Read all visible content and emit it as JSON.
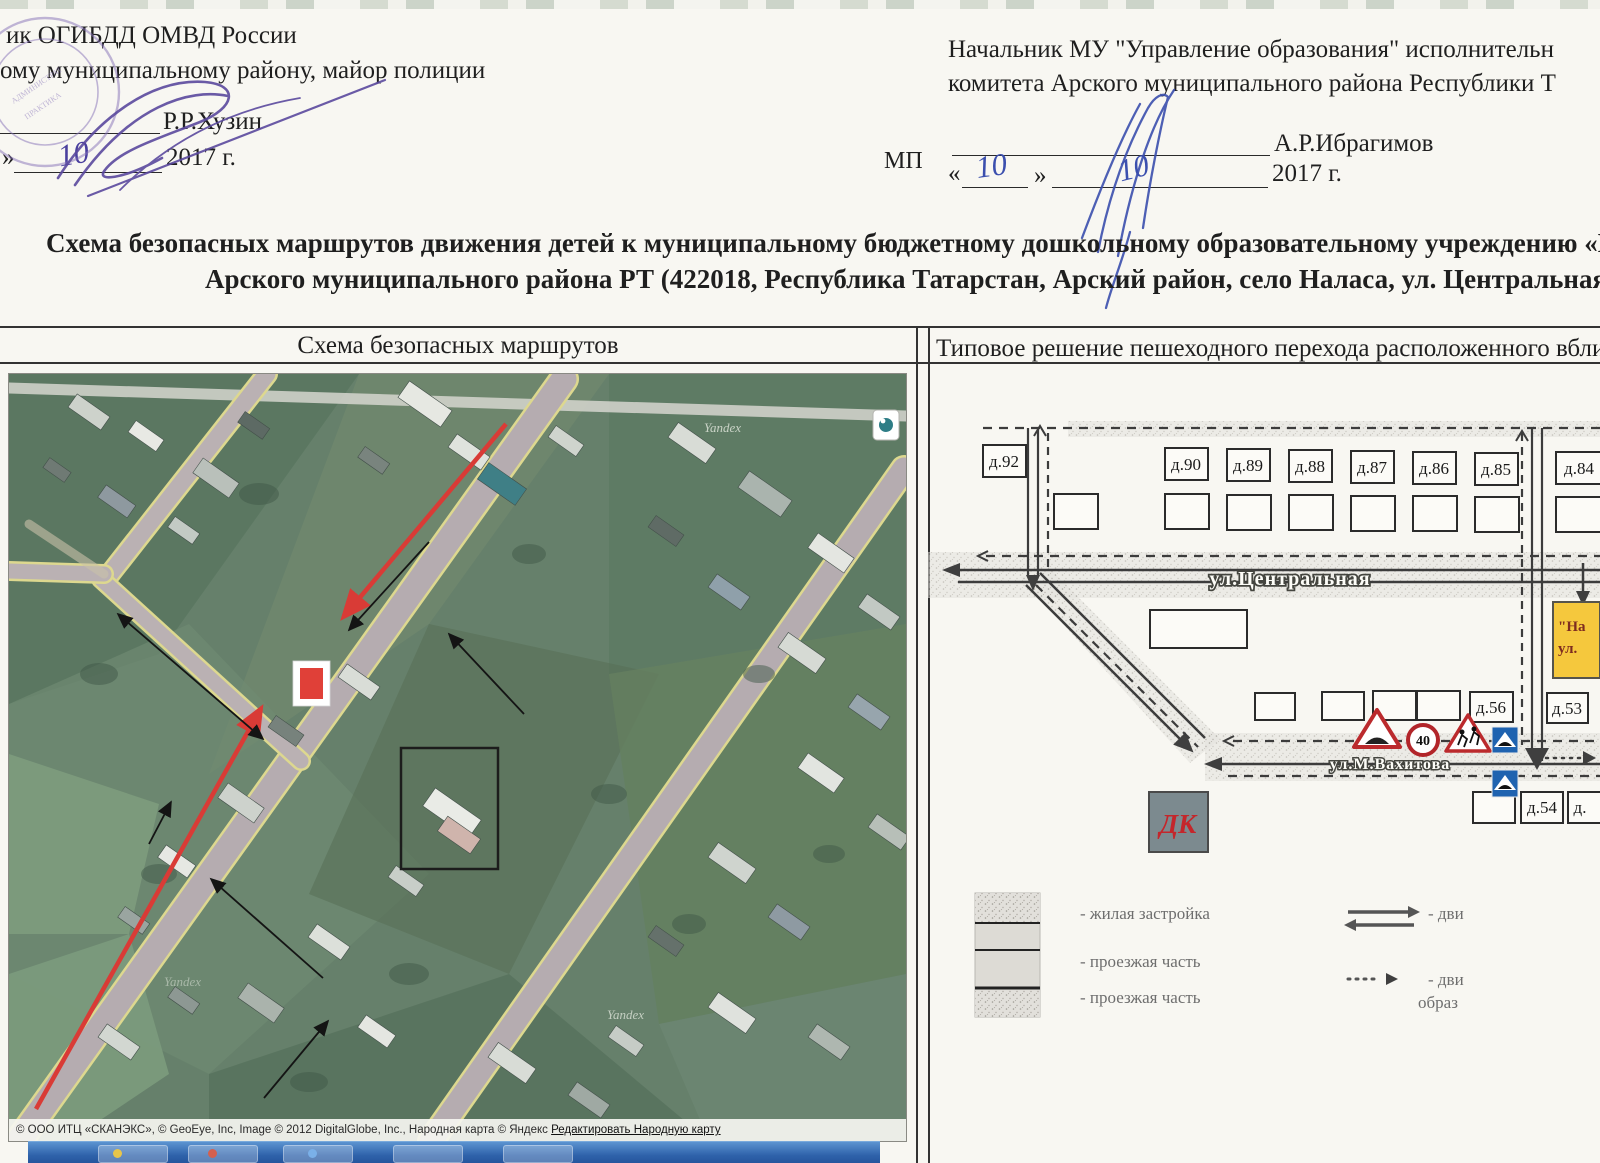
{
  "approvals": {
    "left": {
      "line1": "ик ОГИБДД ОМВД России",
      "line2": "ому муниципальному району, майор полиции",
      "name": "Р.Р.Хузин",
      "quote_close": "»",
      "date_day": "10",
      "year": "2017 г."
    },
    "mp": "МП",
    "right": {
      "line1": "Начальник МУ \"Управление образования\" исполнительн",
      "line2": "комитета Арского муниципального района Республики Т",
      "name": "А.Р.Ибрагимов",
      "quote_open": "«",
      "quote_close": "»",
      "date_day": "10",
      "date_month": "10",
      "year": "2017 г."
    }
  },
  "title": {
    "line1": "Схема безопасных маршрутов движения детей к  муниципальному бюджетному дошкольному образовательному учреждению «На",
    "line2": "Арского муниципального района РТ (422018, Республика Татарстан, Арский район, село Наласа, ул. Центральная"
  },
  "table": {
    "left_header": "Схема безопасных маршрутов",
    "right_header": "Типовое решение пешеходного перехода расположенного вбли"
  },
  "map": {
    "watermark": "Yandex",
    "attribution": "© ООО ИТЦ «СКАНЭКС», © GeoEye, Inc, Image © 2012 DigitalGlobe, Inc., Народная карта © Яндекс ",
    "attribution_link": "Редактировать Народную карту"
  },
  "diagram": {
    "street_central": "ул.Центральная",
    "street_vahitova": "ул.М.Вахитова",
    "houses_top": [
      "д.92",
      "д.90",
      "д.89",
      "д.88",
      "д.87",
      "д.86",
      "д.85",
      "д.84"
    ],
    "house_56": "д.56",
    "house_53": "д.53",
    "house_54": "д.54",
    "house_cut": "д.",
    "kindergarten_line1": "\"На",
    "kindergarten_line2": "ул.",
    "dk_label": "ДК",
    "speed_limit": "40"
  },
  "legend": {
    "items": [
      "- жилая застройка",
      "- проезжая часть",
      "- проезжая часть"
    ],
    "right_item1": "- дви",
    "right_item2": "- дви",
    "right_item2b": "образ"
  },
  "stamp": {
    "text1": "АДМИНИСТРАТ",
    "text2": "ПРАКТИКА"
  },
  "colors": {
    "route_red": "#d93b36",
    "sign_red": "#bb2a2d",
    "sign_blue": "#1f63b0",
    "kindergarten_yellow": "#f5c83d",
    "marker_red": "#e04038",
    "dk_text": "#c4262b"
  }
}
